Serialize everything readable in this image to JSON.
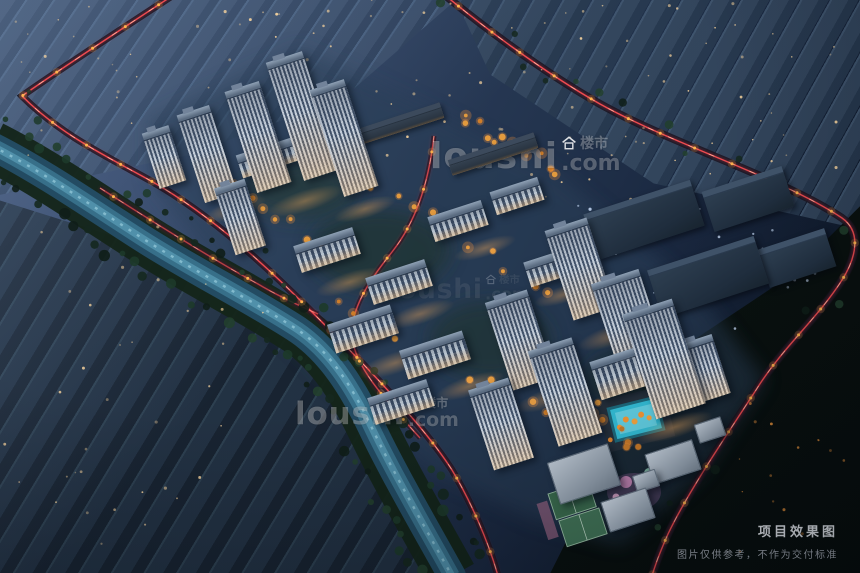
{
  "watermark": {
    "brand": "loushi",
    "tld": ".com",
    "cn_label": "楼市"
  },
  "caption": {
    "title": "项目效果图",
    "disclaimer": "图片仅供参考，不作为交付标准"
  },
  "colors": {
    "traffic_trail_red": "#ff4a50",
    "street_lamp_orange": "#ffb44e",
    "pool_water_cyan": "#38c8e0",
    "river_water_teal": "#4b88a4",
    "autumn_tree_orange": "#e09a3e",
    "night_sky_blue": "#2b3d58"
  }
}
